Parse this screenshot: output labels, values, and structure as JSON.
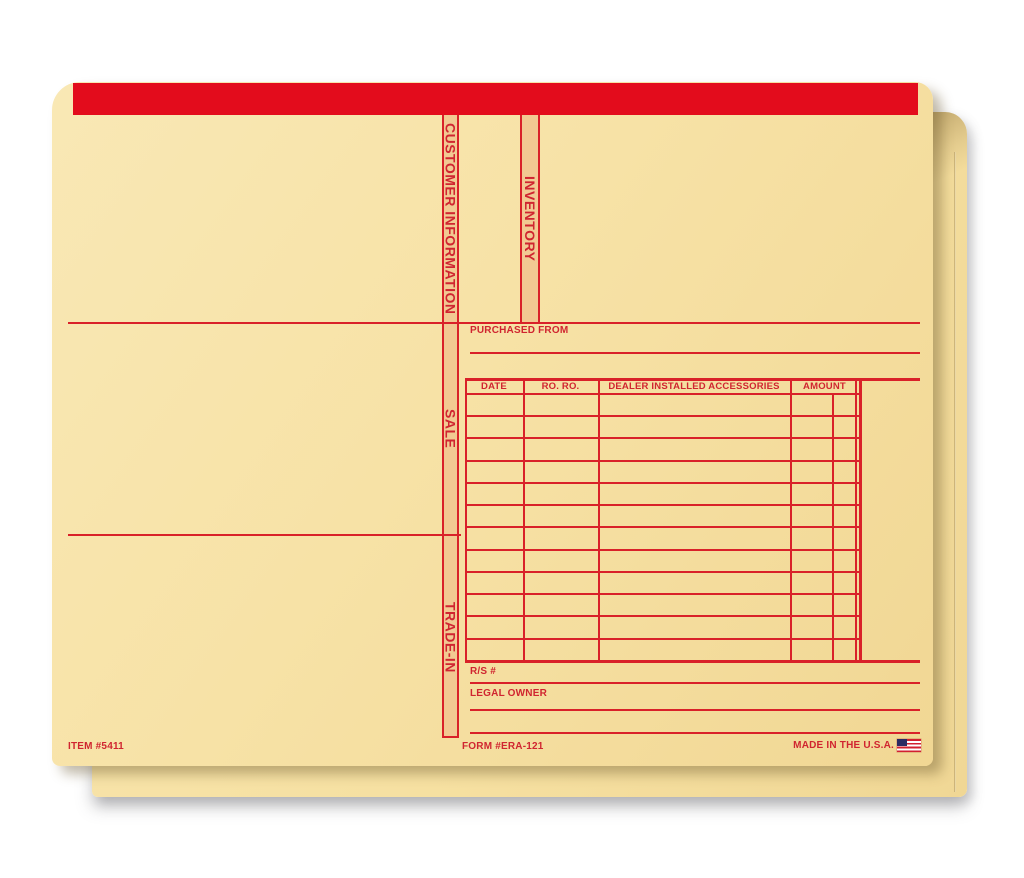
{
  "product": {
    "item_number": "ITEM #5411",
    "form_number": "FORM #ERA-121",
    "made_in": "MADE IN THE U.S.A."
  },
  "tabs": {
    "customer_information": "CUSTOMER INFORMATION",
    "inventory": "INVENTORY",
    "sale": "SALE",
    "trade_in": "TRADE-IN"
  },
  "fields": {
    "purchased_from": "PURCHASED FROM",
    "rs_number": "R/S #",
    "legal_owner": "LEGAL OWNER"
  },
  "table": {
    "columns": [
      "DATE",
      "RO. RO.",
      "DEALER INSTALLED ACCESSORIES",
      "AMOUNT"
    ],
    "data_rows": 12,
    "amount_subcolumns": 2
  },
  "icons": {
    "us_flag": "us-flag-icon"
  },
  "colors": {
    "stripe_red": "#e30c1c",
    "ink_red": "#d92129",
    "manila": "#f7e2a6",
    "tab_fill": "#f2c992",
    "background": "#ffffff"
  }
}
